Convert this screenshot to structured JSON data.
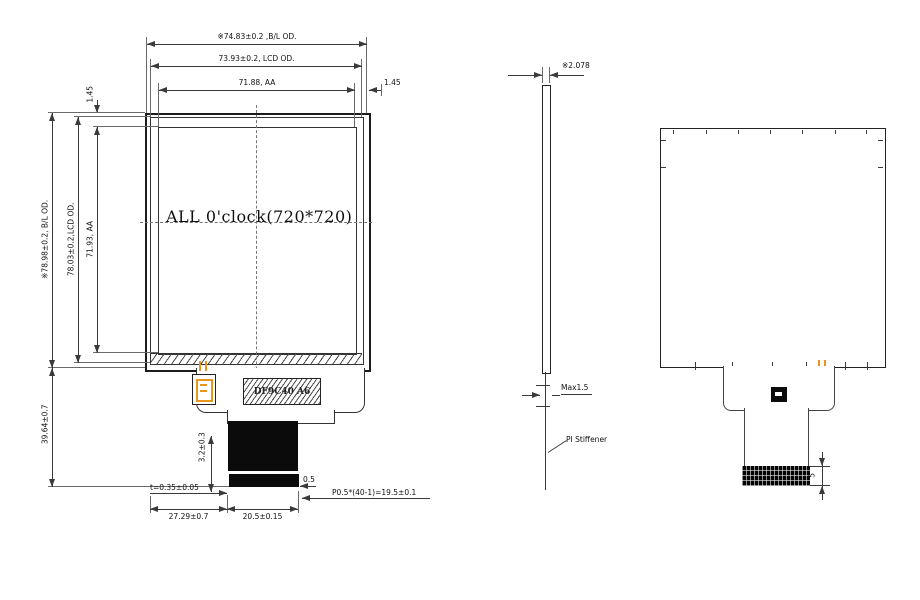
{
  "colors": {
    "accent": "#e8971e",
    "line": "#3a3a3a"
  },
  "front": {
    "aa_text": "ALL 0'clock(720*720)",
    "ic_label": "DF9C40 A6",
    "dims": {
      "bl_h": "※74.83±0.2 ,B/L OD.",
      "lcd_h": "73.93±0.2, LCD OD.",
      "aa_h": "71.88, AA",
      "margin_r": "1.45",
      "margin_t": "1.45",
      "bl_v": "※78.98±0.2, B/L OD.",
      "lcd_v": "78.03±0.2,LCD OD.",
      "aa_v": "71.93, AA",
      "tail_len": "39.64±0.7",
      "stiff_h": "3.2±0.3",
      "thickness": "t=0.35±0.05",
      "edge_gap": "0.5",
      "pitch": "P0.5*(40-1)=19.5±0.1",
      "fpc_w1": "27.29±0.7",
      "fpc_w2": "20.5±0.15"
    }
  },
  "side": {
    "dims": {
      "thickness": "※2.078",
      "fpc_max": "Max1.5"
    },
    "stiffener": "PI Stiffener"
  },
  "back": {
    "dims": {
      "connector_h": "5"
    }
  }
}
